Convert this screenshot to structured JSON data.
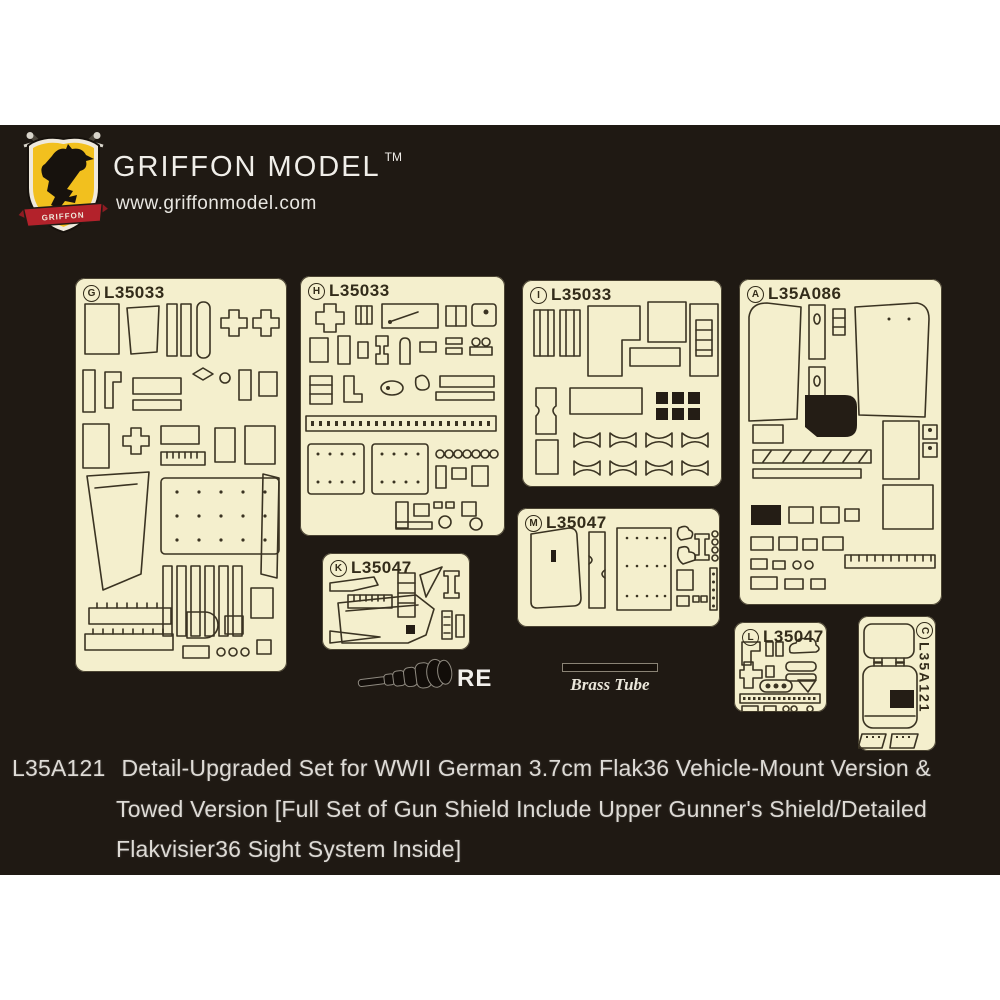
{
  "brand": {
    "name": "GRIFFON MODEL",
    "trademark": "TM",
    "website": "www.griffonmodel.com",
    "shield_banner_text": "GRIFFON",
    "colors": {
      "shield_yellow": "#f2c01e",
      "banner_red": "#b3222b",
      "text": "#f0eee9"
    }
  },
  "frets": {
    "g": {
      "letter": "G",
      "code": "L35033"
    },
    "h": {
      "letter": "H",
      "code": "L35033"
    },
    "i": {
      "letter": "I",
      "code": "L35033"
    },
    "a": {
      "letter": "A",
      "code": "L35A086"
    },
    "m": {
      "letter": "M",
      "code": "L35047"
    },
    "k": {
      "letter": "K",
      "code": "L35047"
    },
    "l": {
      "letter": "L",
      "code": "L35047"
    },
    "c": {
      "letter": "C",
      "code": "L35A121"
    }
  },
  "fret_colors": {
    "brass_cream": "#f4efcd",
    "etch_line": "#3a3322",
    "panel_background": "#1f1913"
  },
  "accessories": {
    "barrel_label": "RE",
    "tube_label": "Brass Tube"
  },
  "description": {
    "code": "L35A121",
    "line1": "Detail-Upgraded Set for WWII German 3.7cm Flak36 Vehicle-Mount Version &",
    "line2": "Towed Version [Full Set of Gun Shield Include Upper Gunner's Shield/Detailed",
    "line3": "Flakvisier36 Sight System Inside]"
  }
}
